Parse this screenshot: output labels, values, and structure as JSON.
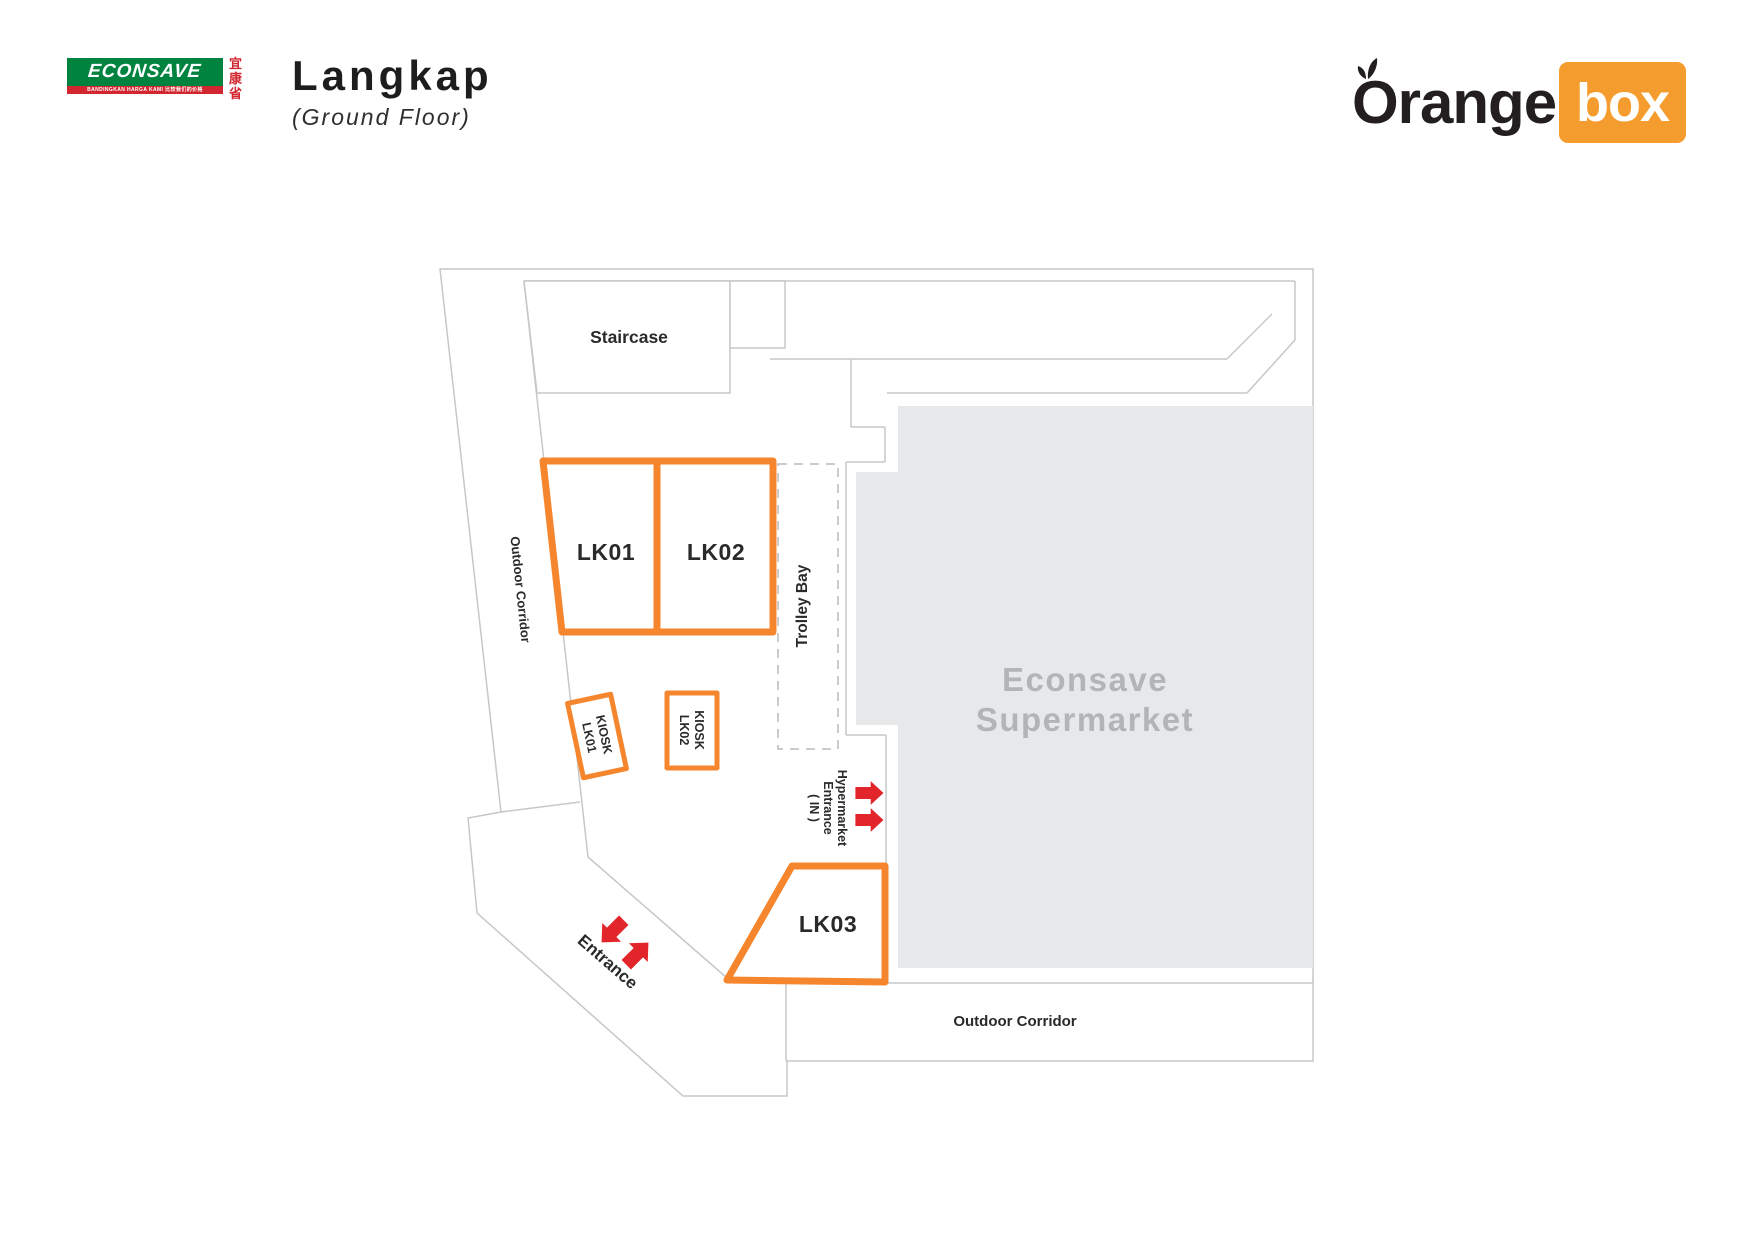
{
  "header": {
    "econsave": {
      "wordmark": "ECONSAVE",
      "tagline": "BANDINGKAN HARGA KAMI 比较我们的价格",
      "chinese_chars": [
        "宜",
        "康",
        "省"
      ]
    },
    "title": "Langkap",
    "subtitle": "(Ground Floor)",
    "orangebox": {
      "orange": "Orange",
      "box": "box"
    }
  },
  "plan": {
    "staircase_label": "Staircase",
    "units": {
      "lk01": "LK01",
      "lk02": "LK02",
      "lk03": "LK03"
    },
    "kiosks": {
      "k1_line1": "KIOSK",
      "k1_line2": "LK01",
      "k2_line1": "KIOSK",
      "k2_line2": "LK02"
    },
    "trolley_bay": "Trolley Bay",
    "hypermarket_entrance": {
      "line1": "Hypermarket",
      "line2": "Entrance",
      "line3": "( IN )"
    },
    "supermarket": {
      "line1": "Econsave",
      "line2": "Supermarket"
    },
    "outdoor_corridor_left": "Outdoor Corridor",
    "outdoor_corridor_bottom": "Outdoor Corridor",
    "entrance": "Entrance"
  },
  "colors": {
    "unit_orange": "#F6862D",
    "logo_orange": "#F59C2E",
    "arrow_red": "#E2252B",
    "econsave_green": "#00833E",
    "econsave_red": "#D22630",
    "supermarket_fill": "#E7E8EA",
    "supermarket_text": "#B2B5B8",
    "line_gray": "#C5C7C9",
    "text_dark": "#2B2A29"
  }
}
